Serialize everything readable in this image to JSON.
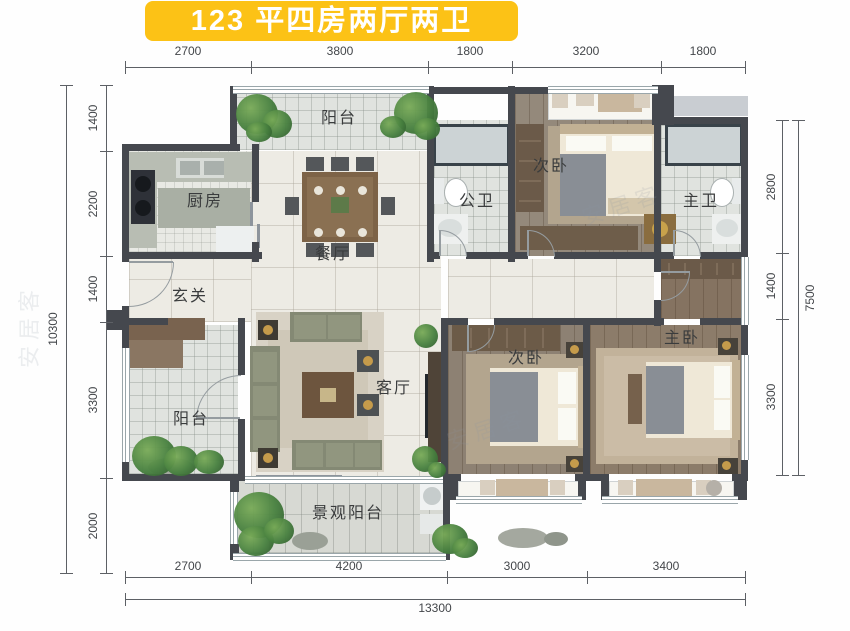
{
  "title": "123 平四房两厅两卫",
  "watermark": "安居客",
  "rooms": {
    "balcony_top": "阳台",
    "kitchen": "厨房",
    "dining": "餐厅",
    "foyer": "玄关",
    "guest_bath": "公卫",
    "bedroom2": "次卧",
    "master_bath": "主卫",
    "balcony_side": "阳台",
    "living": "客厅",
    "bedroom3": "次卧",
    "master_bedroom": "主卧",
    "balcony_view": "景观阳台"
  },
  "dimensions": {
    "top": [
      "2700",
      "3800",
      "1800",
      "3200",
      "1800"
    ],
    "bottom": [
      "2700",
      "4200",
      "3000",
      "3400"
    ],
    "bottom_total": "13300",
    "left": [
      "1400",
      "2200",
      "1400",
      "3300",
      "2000"
    ],
    "left_total": "10300",
    "right": [
      "2800",
      "1400",
      "3300"
    ],
    "right_total": "7500"
  }
}
